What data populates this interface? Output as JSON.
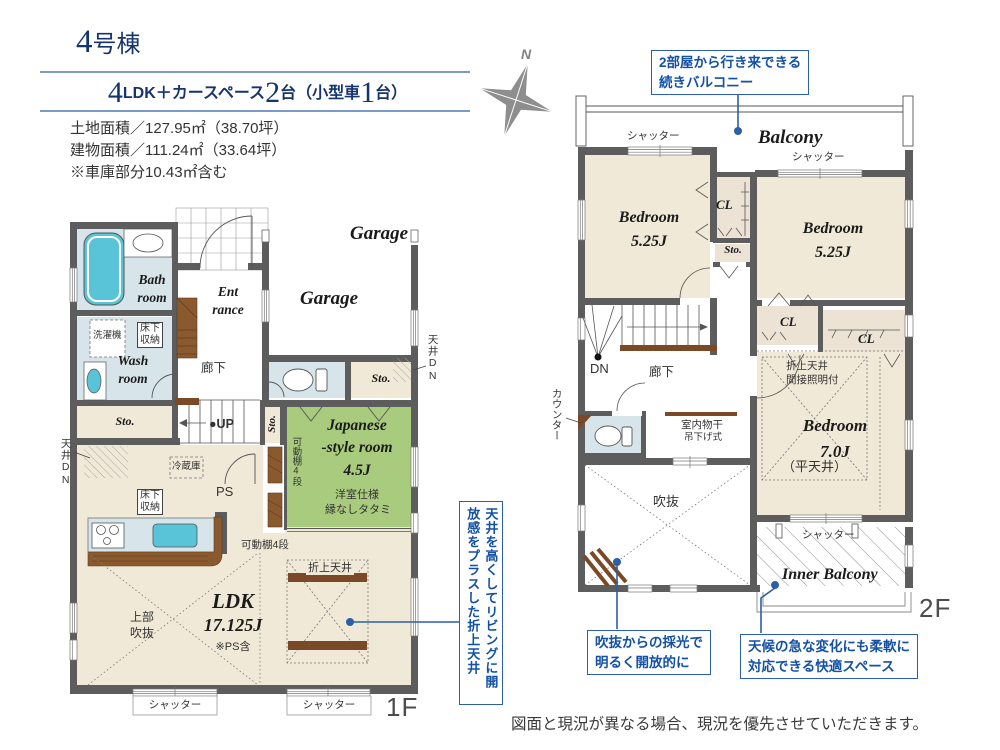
{
  "header": {
    "title_num": "4",
    "title_suffix": "号棟",
    "spec": {
      "n1": "4",
      "t1": "LDK＋カースペース",
      "n2": "2",
      "t2": "台（小型車",
      "n3": "1",
      "t3": "台）"
    },
    "land_area": "土地面積／127.95㎡（38.70坪）",
    "building_area": "建物面積／111.24㎡（33.64坪）",
    "garage_note": "※車庫部分10.43㎡含む"
  },
  "compass": {
    "north": "N"
  },
  "callouts": {
    "balcony": "2部屋から行き来できる\n続きバルコニー",
    "ceiling": "天井を高くしてリビングに開放感をプラスした折上天井",
    "void_light": "吹抜からの採光で\n明るく開放的に",
    "inner_balcony": "天候の急な変化にも柔軟に\n対応できる快適スペース"
  },
  "shared": {
    "shutter": "シャッター",
    "sto": "Sto.",
    "cl": "CL",
    "ceiling_dn": "天井DN",
    "underfloor_storage": "床下\n収納",
    "movable_shelf": "可動棚4段",
    "folded_ceiling": "折上天井",
    "hallway": "廊下"
  },
  "floor1": {
    "label": "1F",
    "bath": "Bath\nroom",
    "wash": "Wash\nroom",
    "washing_machine": "洗濯機",
    "entrance": "Ent\nrance",
    "garage_outside": "Garage",
    "garage": "Garage",
    "up": "●UP",
    "fridge": "冷蔵庫",
    "ps": "PS",
    "japanese_room": "Japanese\n-style room\n4.5J",
    "japanese_note1": "洋室仕様",
    "japanese_note2": "縁なしタタミ",
    "ldk": "LDK",
    "ldk_size": "17.125J",
    "ldk_note": "※PS含",
    "upper_void": "上部\n吹抜"
  },
  "floor2": {
    "label": "2F",
    "balcony": "Balcony",
    "bedroom525": "Bedroom\n5.25J",
    "dn": "DN",
    "counter": "カウンター",
    "indoor_drying": "室内物干",
    "drying_type": "吊下げ式",
    "folded_ceiling_note": "折上天井\n間接照明付",
    "bedroom7": "Bedroom\n7.0J",
    "flat_ceiling": "（平天井）",
    "void": "吹抜",
    "inner_balcony": "Inner Balcony"
  },
  "footer": {
    "disclaimer": "図面と現況が異なる場合、現況を優先させていただきます。"
  }
}
